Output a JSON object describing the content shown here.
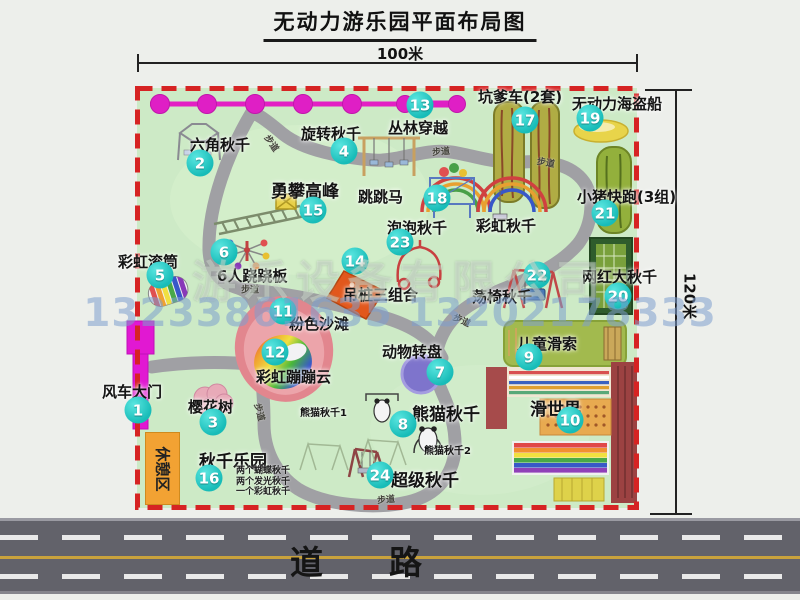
{
  "title": "无动力游乐园平面布局图",
  "dims": {
    "width": "100米",
    "height": "120米"
  },
  "road": {
    "label": "道　　路"
  },
  "watermark": {
    "company": "游乐设备有限公司",
    "phones": "13233861635 13202178333"
  },
  "rest_area": "休憩区",
  "path_label": "步道",
  "rainbow_swing": "彩虹秋千",
  "notes": {
    "panda1": "熊猫秋千1",
    "panda2": "熊猫秋千2",
    "swing_park": [
      "两个蝴蝶秋千",
      "两个发光秋千",
      "一个彩虹秋千"
    ]
  },
  "colors": {
    "badge": "#18bcb8",
    "border": "#d62323",
    "grass": "#cdeac6",
    "zipline": "#e31fc4"
  },
  "attractions": [
    {
      "num": "1",
      "label": "风车大门"
    },
    {
      "num": "2",
      "label": "六角秋千"
    },
    {
      "num": "3",
      "label": "樱花树"
    },
    {
      "num": "4",
      "label": "旋转秋千"
    },
    {
      "num": "5",
      "label": "彩虹滚筒"
    },
    {
      "num": "6",
      "label": "6人跷跷板"
    },
    {
      "num": "7",
      "label": "动物转盘"
    },
    {
      "num": "8",
      "label": "熊猫秋千"
    },
    {
      "num": "9",
      "label": "儿童滑索"
    },
    {
      "num": "10",
      "label": "滑世界"
    },
    {
      "num": "11",
      "label": "粉色沙滩"
    },
    {
      "num": "12",
      "label": "彩虹蹦蹦云"
    },
    {
      "num": "13",
      "label": "丛林穿越"
    },
    {
      "num": "14",
      "label": "吊桩三组合"
    },
    {
      "num": "15",
      "label": "勇攀高峰"
    },
    {
      "num": "16",
      "label": "秋千乐园"
    },
    {
      "num": "17",
      "label": "坑爹车(2套)"
    },
    {
      "num": "18",
      "label": "跳跳马"
    },
    {
      "num": "19",
      "label": "无动力海盗船"
    },
    {
      "num": "20",
      "label": "网红大秋千"
    },
    {
      "num": "21",
      "label": "小猪快跑(3组)"
    },
    {
      "num": "22",
      "label": "荡椅秋千"
    },
    {
      "num": "23",
      "label": "泡泡秋千"
    },
    {
      "num": "24",
      "label": "超级秋千"
    }
  ]
}
